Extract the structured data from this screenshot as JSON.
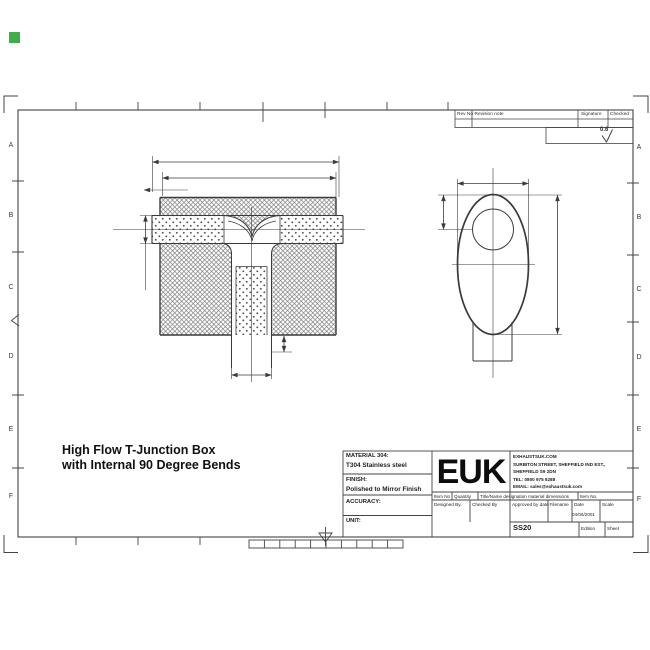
{
  "drawing_title": {
    "line1": "High Flow T-Junction Box",
    "line2": "with Internal 90 Degree Bends"
  },
  "zone_letters": [
    "A",
    "B",
    "C",
    "D",
    "E",
    "F"
  ],
  "revision_table": {
    "col1": "Rev No",
    "col2": "Revision note",
    "col3": "Signature",
    "col4": "Checked"
  },
  "surface_finish": {
    "value": "0.6"
  },
  "title_block": {
    "material_label": "MATERIAL 304:",
    "material_value": "T304 Stainless steel",
    "finish_label": "FINISH:",
    "finish_value": "Polished to Mirror Finish",
    "accuracy_label": "ACCURACY:",
    "unit_label": "UNIT:",
    "logo": "EUK",
    "company_lines": [
      "EXHAUSTSUK.COM",
      "SURBITON STREET, SHEFFIELD IND EST.,",
      "SHEFFIELD S9 2DN",
      "TEL: 0800 975 9288",
      "EMAIL: sales@exhaustsuk.com"
    ],
    "item_row": [
      "Item No",
      "Quantity",
      "Title/Name designation material dimensions",
      "Item No."
    ],
    "approval_row": [
      "Designed By.",
      "Checked By",
      "Approved by date",
      "Filename",
      "Date",
      "Scale"
    ],
    "date_value": "04/06/2001",
    "drawing_number": "SS20",
    "edition_label": "Edition",
    "sheet_label": "Sheet"
  },
  "marker_color": "#3fae49"
}
